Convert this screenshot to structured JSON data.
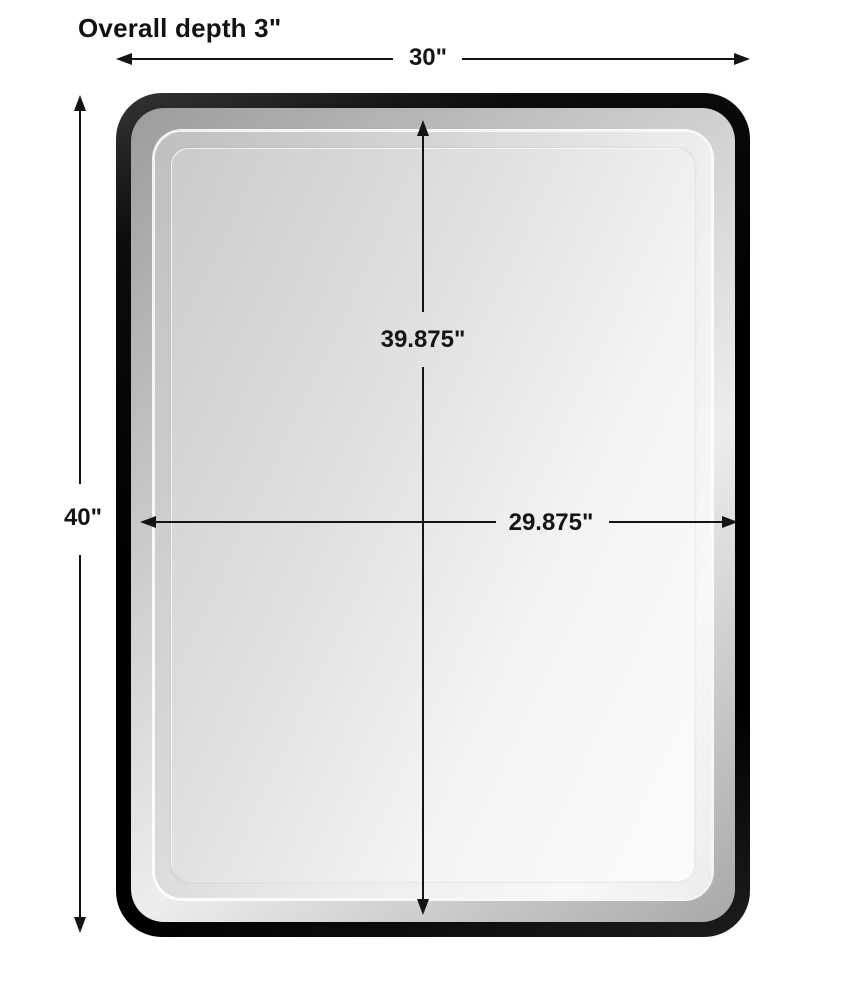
{
  "diagram": {
    "title": "Overall depth 3\"",
    "product": "rounded-rectangle framed mirror",
    "dimensions": {
      "overall_width": "30\"",
      "overall_height": "40\"",
      "mirror_height": "39.875\"",
      "mirror_width": "29.875\""
    },
    "colors": {
      "background": "#ffffff",
      "frame": "#0b0b0b",
      "bevel": "#b9b9b9",
      "dimension_line": "#141414",
      "text": "#111111"
    }
  }
}
